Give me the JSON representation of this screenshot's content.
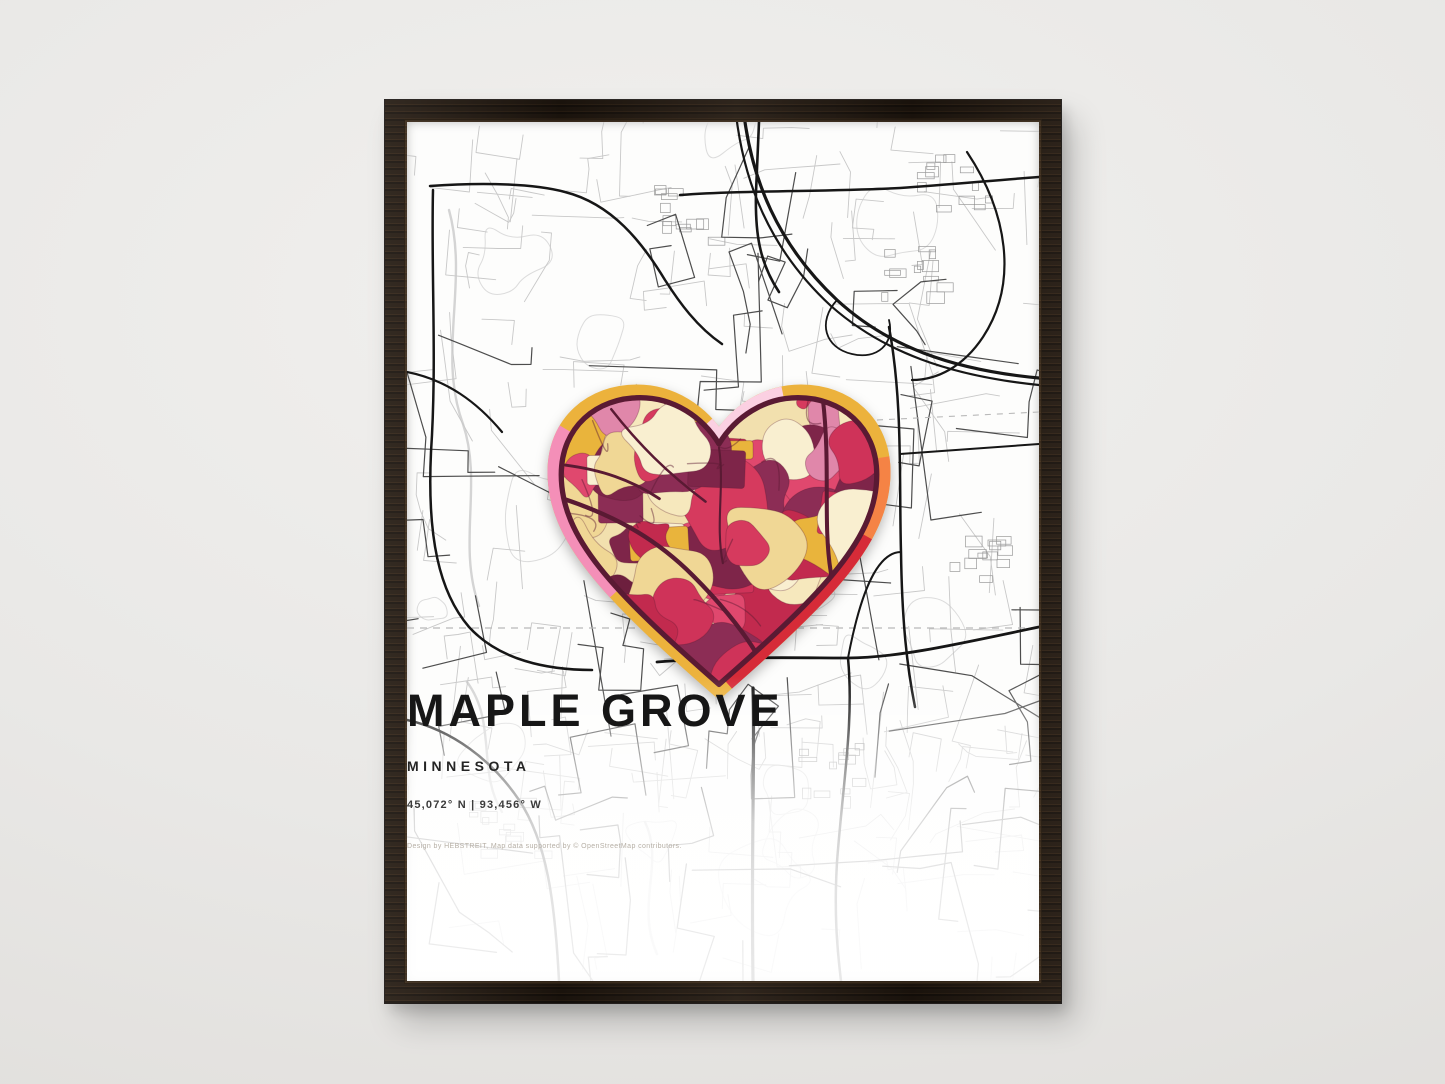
{
  "poster": {
    "title": "MAPLE GROVE",
    "subtitle": "MINNESOTA",
    "coordinates": "45,072° N | 93,456° W",
    "credit": "Design by HEBSTREIT, Map data supported by © OpenStreetMap contributors."
  },
  "scene": {
    "wall_color": "#e9e8e6",
    "frame_wood_color": "#241a11",
    "paper_color": "#fdfdfc"
  },
  "map": {
    "background_color": "#fdfdfc",
    "minor_road_color": "#c8c8c8",
    "medium_road_color": "#4d4d4d",
    "major_road_color": "#161616",
    "contour_color": "#dcdcdc",
    "stream_color": "#d4d4d4",
    "boundary_dash_color": "#b9b9b9"
  },
  "heart": {
    "outline_color": "#5a1a33",
    "base_color": "#f2e0ae",
    "inner_road_color": "#5a1a33",
    "ring_base_color": "#ecb23c",
    "ring_segments": [
      {
        "name": "left-pink",
        "color": "#f48fb8",
        "from": 14,
        "to": 32
      },
      {
        "name": "notch-light-pink",
        "color": "#fbd0e2",
        "from": 48,
        "to": 58
      },
      {
        "name": "right-orange",
        "color": "#f58345",
        "from": 71,
        "to": 79
      },
      {
        "name": "right-red",
        "color": "#d62b38",
        "from": 79,
        "to": 99
      }
    ],
    "mosaic_palette": {
      "reds": [
        "#d63a5e",
        "#c22a4e",
        "#cf3359",
        "#e0486e"
      ],
      "maroons": [
        "#6d1f3e",
        "#7e2549",
        "#8c2d55"
      ],
      "warms": [
        "#e9b43c",
        "#f0d795",
        "#f6e8bd",
        "#f9efd0"
      ],
      "pinks": [
        "#e087aa"
      ]
    }
  }
}
